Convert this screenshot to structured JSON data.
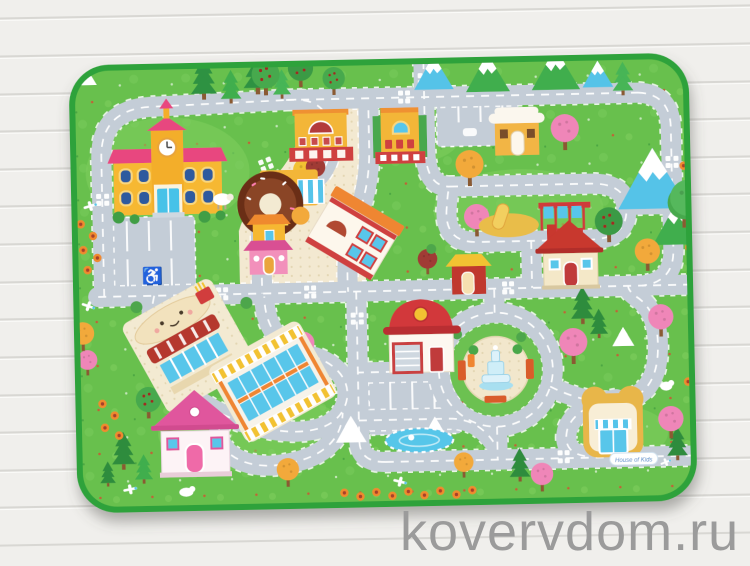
{
  "scene": {
    "description": "Children's city road-map play mat photographed on a white wooden plank floor"
  },
  "watermark": {
    "text": "kovervdom.ru",
    "color": "#9b9b9b"
  },
  "mat": {
    "brand_label": "House of Kids",
    "symbols": {
      "disabled_parking": "♿"
    },
    "palette": {
      "grass": "#68c04d",
      "grass_light": "#7ecd5f",
      "edge_green": "#2da23b",
      "road": "#c4cdd7",
      "road_line": "#ffffff",
      "plaza_cream": "#f3e9d1",
      "water_blue": "#56c6e9",
      "building_yellow": "#f5b733",
      "accent_red": "#cf3b33",
      "roof_pink": "#e8467f",
      "wood_bg": "#f0efec",
      "plank_line": "#d8d7d3",
      "watermark_gray": "#9b9b9b"
    },
    "elements": [
      "school",
      "theater",
      "town-hall",
      "donut-shop",
      "bakery",
      "grocery-kiosk",
      "clinic",
      "yellow-cottage",
      "playground",
      "parking-lots",
      "burger-cafe",
      "shopping-mall",
      "pink-cottage",
      "fire-station",
      "fountain-roundabout",
      "bread-kiosk",
      "cream-cottage",
      "red-kiosk",
      "pond",
      "mountains",
      "pine-trees",
      "apple-trees",
      "blossom-trees",
      "sheep",
      "chick",
      "airplanes",
      "flowers"
    ]
  }
}
